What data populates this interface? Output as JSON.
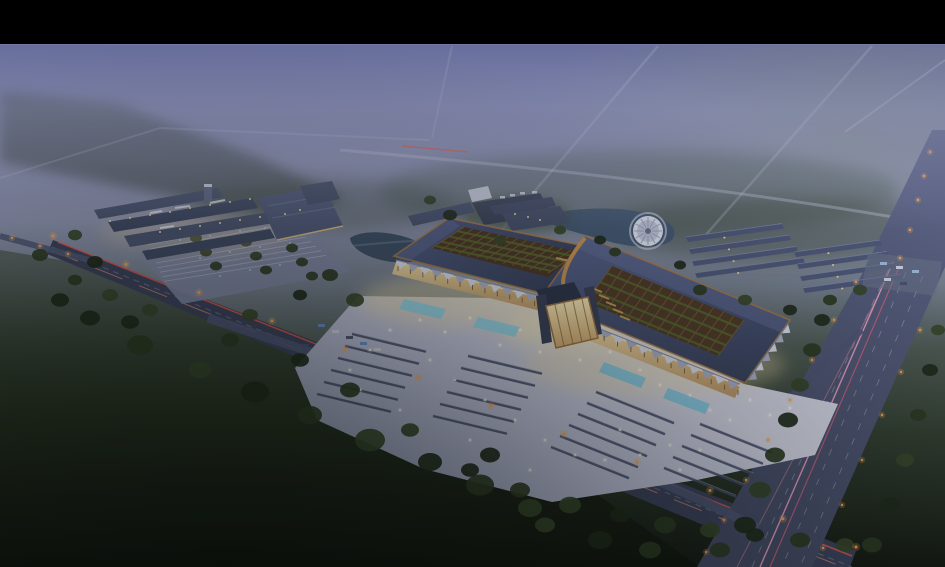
{
  "meta": {
    "title": "Aerial twilight rendering of a traditional-roofed market complex",
    "image_type": "architectural-rendering",
    "time_of_day": "dusk with low fog"
  },
  "scene": {
    "elements": [
      "black letterbox bar at top",
      "violet evening haze over distant fields and tree lines",
      "faint far roads converging into the fog",
      "main two-winged market hall with dark slate roofs, copper eave trim and open timber-lattice courtyards",
      "central illuminated gateway pavilion between the wings",
      "sawtooth colonnade canopies with warm lit walls",
      "bright forecourt plaza with market stall rows, glowing blue pools and scattered lights",
      "secondary retail complex at left with lit facades and striped parking lot",
      "pond with circular fountain pavilion",
      "parallel rows of warehouse shops at right",
      "diagonal arterial road with red tail-light streaks and orange lamps",
      "wide multi-lane avenue with pink light trails at right",
      "dark farmland and dense tree belts in the foreground"
    ]
  },
  "colors": {
    "letterbox": "#000000",
    "skyTop": "#62689a",
    "skyUpper": "#7d83a9",
    "fog": "#8b90b2",
    "fogGreen": "#7e8a80",
    "groundFar": "#6f7a88",
    "groundMid": "#4e5a52",
    "fieldGreen": "#26301f",
    "groundDark": "#141a13",
    "treeDark": "#1f2a1c",
    "treeMid": "#2c3a24",
    "treeLight": "#36452b",
    "forestHaze": "#45544a",
    "roofSlate": "#3f4963",
    "roofSlateLight": "#515c82",
    "roofPitchLight": "#5b6690",
    "copper": "#b8854f",
    "copperDark": "#9a7248",
    "courtyardBrown": "#4a3829",
    "courtyardFin": "#76573a",
    "courtyardGreen": "#57672f",
    "plazaBright": "#d2d4e4",
    "plazaMid": "#b8bcd4",
    "plazaEdge": "#8f95b2",
    "warmGlow": "#f0dca6",
    "warmWall": "#e2bb82",
    "windowWarm": "#f4d79a",
    "gateFace": "#f2e2b4",
    "sawtoothLight": "#d6dae8",
    "sawtoothShade": "#a9aec6",
    "stall": "#454c6a",
    "poolBlue": "#8ad2e8",
    "water": "#445872",
    "fountainDeck": "#d8dcea",
    "road": "#3b425c",
    "roadMinor": "#4e5574",
    "avenueTop": "#5b6284",
    "avenueBottom": "#434a64",
    "laneLine": "#c3c7da",
    "redStreak": "#e0584a",
    "redStreakSoft": "#ff9a72",
    "pinkStreak": "#f0a0c4",
    "pinkStreakDeep": "#d4607e",
    "orangeLamp": "#f0a356",
    "coolLamp": "#86c8f0",
    "white": "#ffffff",
    "parkingLot": "#7e85a2",
    "parkingLine": "#b9bdd0",
    "towerCap": "#c6cbdc",
    "buildingWhite": "#c2c7d6"
  }
}
